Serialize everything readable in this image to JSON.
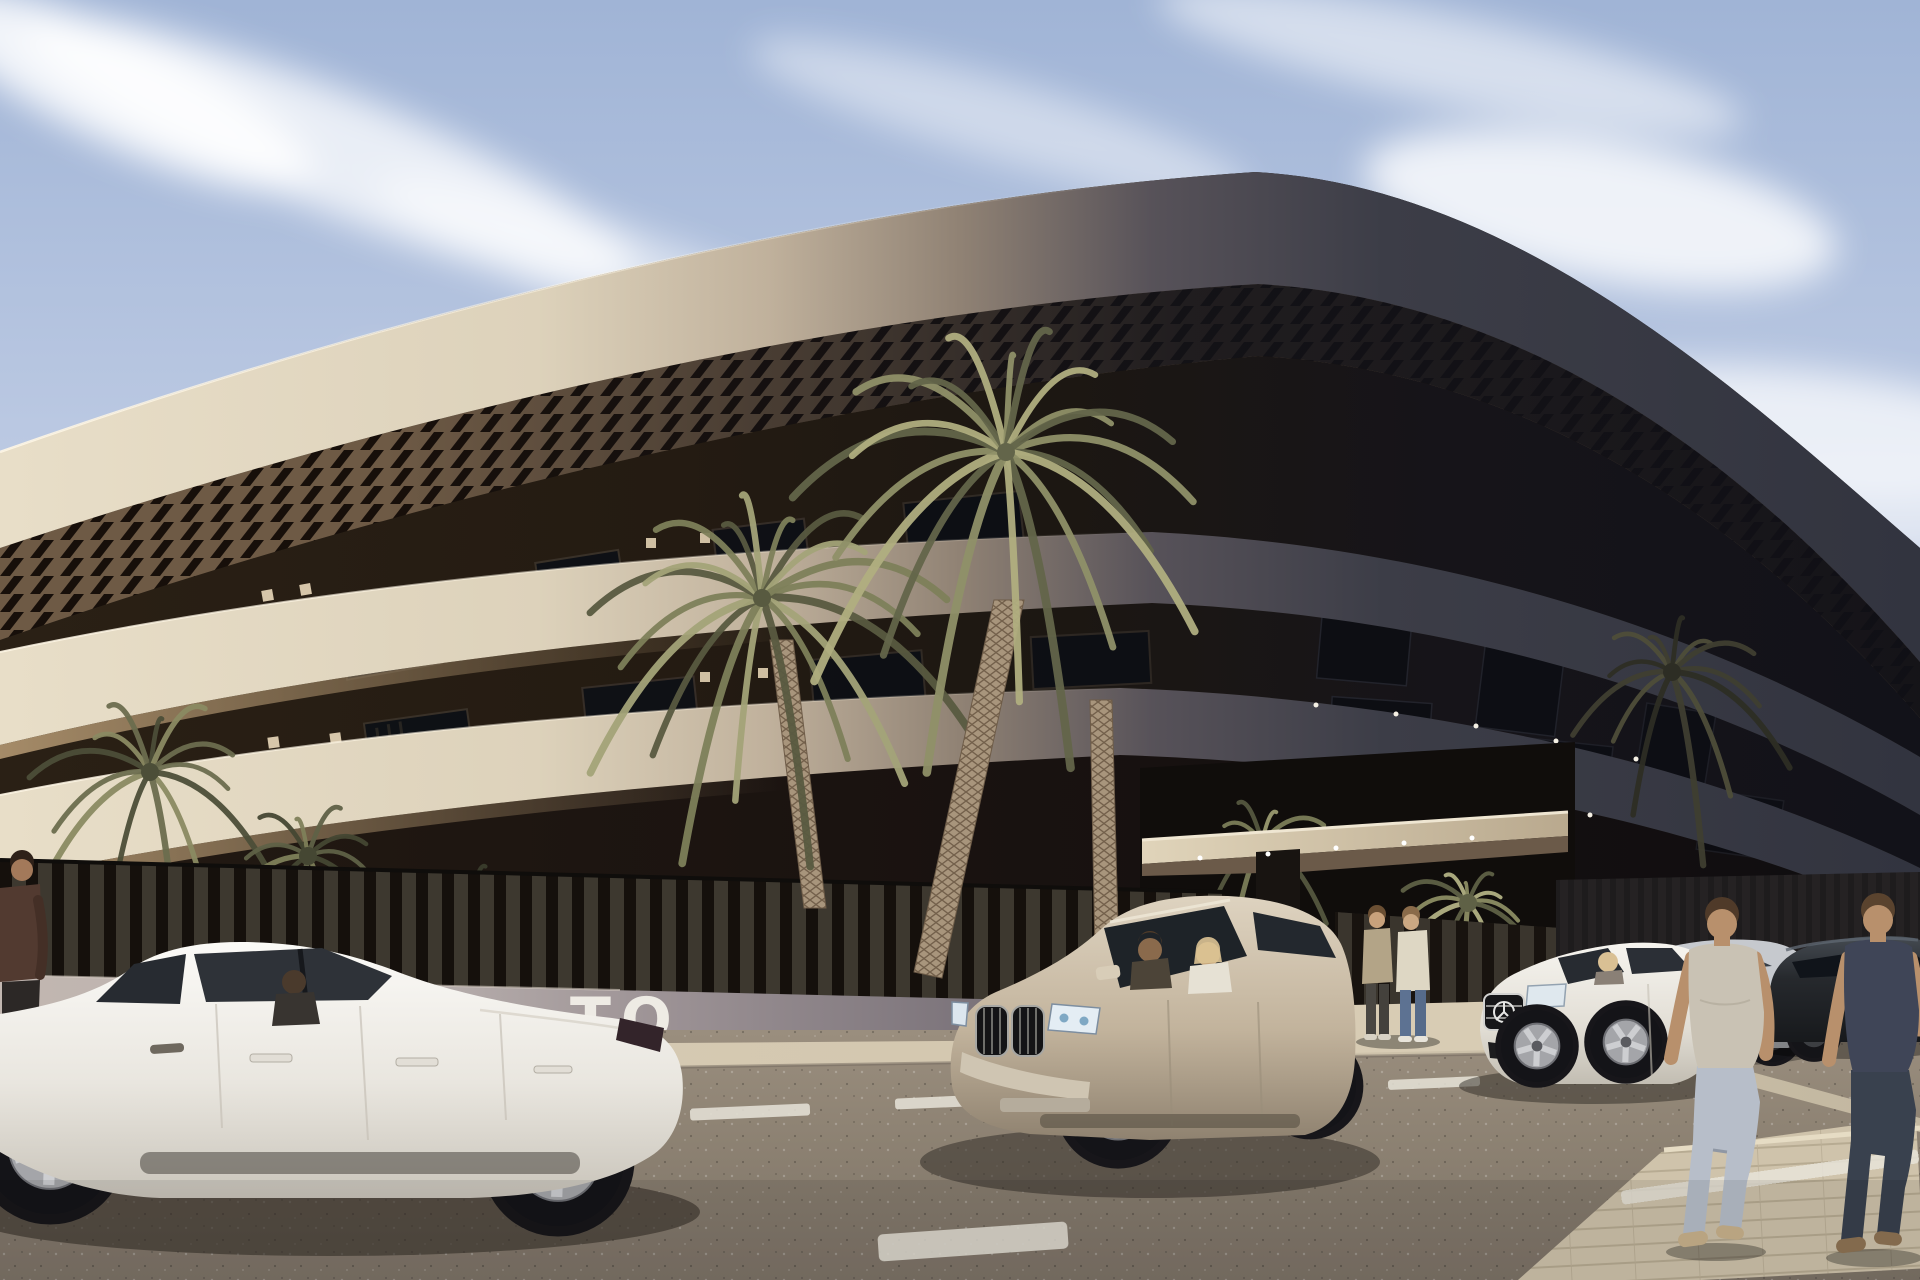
{
  "page": {
    "title": "New-build apartment complex — street view render"
  },
  "signage": {
    "wall_text": "TO"
  },
  "scene": {
    "description": "Sunlit 3D render of a long curved cream apartment building with dark pergola slats, palm trees, a slatted perimeter fence, an entrance canopy, parked cars and pedestrians on the street",
    "time_of_day": "day",
    "objects": [
      "curved apartment building",
      "pergola slats",
      "balcony bands",
      "perimeter slat fence",
      "low wall with lettering",
      "entrance canopy",
      "palm trees",
      "white sedan",
      "champagne suv",
      "white mercedes coupe",
      "silver sedan",
      "dark sedan",
      "standing pedestrians",
      "walking pedestrians",
      "asphalt road",
      "white road markings",
      "paved sidewalk",
      "wispy clouds"
    ]
  },
  "palette": {
    "sky_blue": "#a7bad9",
    "cloud_white": "#ffffff",
    "facade_cream": "#e2d8c2",
    "facade_shadow": "#32343f",
    "recess_dark": "#1c1712",
    "palm_olive": "#8f9068",
    "wall_mauve": "#a89da0",
    "asphalt_gray": "#8b8071",
    "sidewalk_sand": "#cfc3ab",
    "suv_champagne": "#c9baa4",
    "car_white": "#f4f2ed",
    "signage_white": "#f2efe8"
  }
}
